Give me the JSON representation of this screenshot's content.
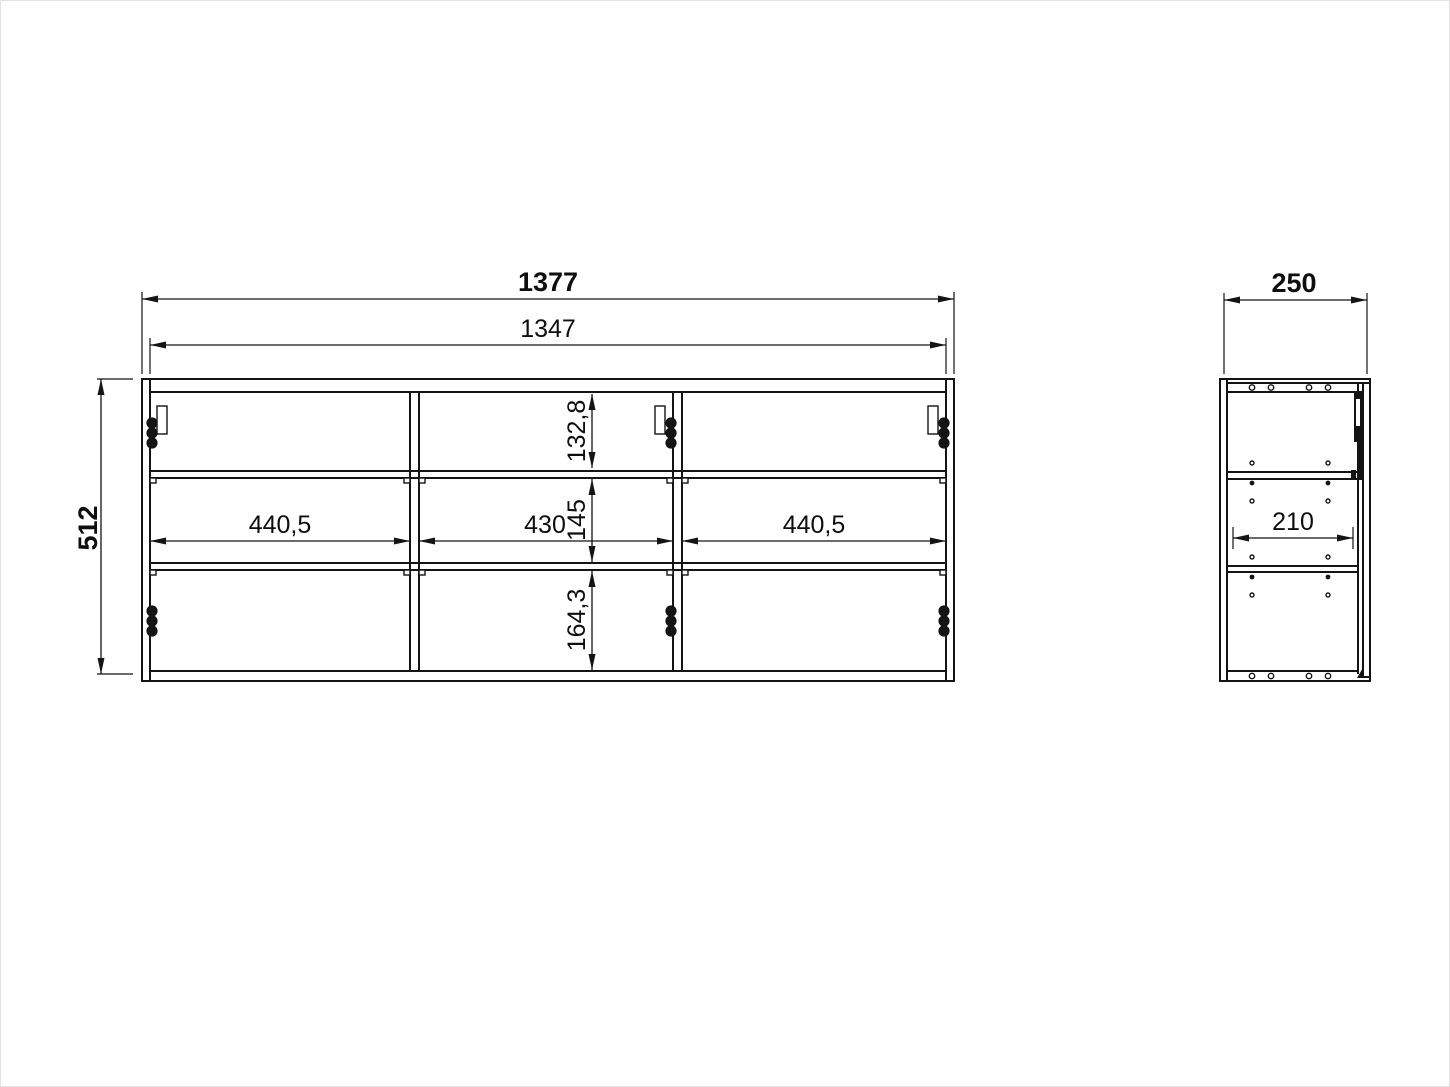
{
  "drawing": {
    "type": "furniture-dimension-drawing",
    "background_color": "#ffffff",
    "line_color": "#141414",
    "front_view": {
      "overall_width": "1377",
      "inner_width": "1347",
      "overall_height": "512",
      "column_widths": [
        "440,5",
        "430",
        "440,5"
      ],
      "row_heights": [
        "132,8",
        "145",
        "164,3"
      ],
      "columns": 3,
      "rows": 3
    },
    "side_view": {
      "overall_depth": "250",
      "inner_depth": "210"
    }
  }
}
